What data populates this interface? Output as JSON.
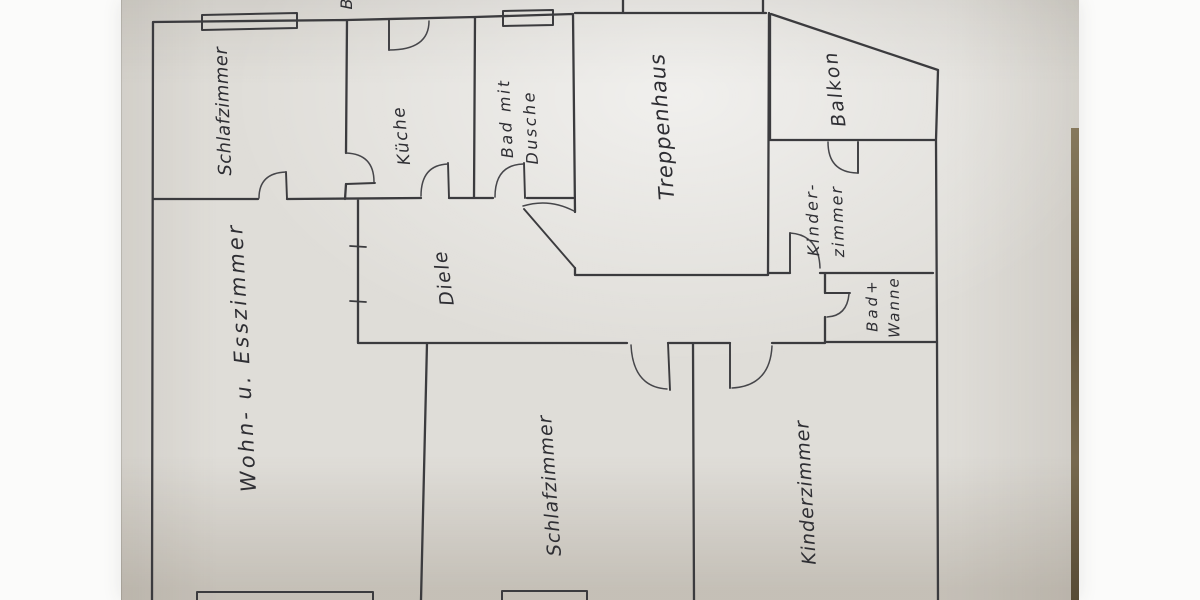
{
  "photo": {
    "description": "hand-drawn apartment floor plan on paper",
    "margin_color": "#fbfbfa",
    "paper_color": "#dfddd8",
    "ink_color": "#3b3b3e",
    "table_edge_color": "#5a4c31"
  },
  "floorplan": {
    "partial_top_label": "B",
    "rooms": [
      {
        "id": "schlafzimmer-oben",
        "label": "Schlafzimmer"
      },
      {
        "id": "kueche",
        "label": "Küche"
      },
      {
        "id": "bad-mit-dusche",
        "label": "Bad mit",
        "label2": "Dusche"
      },
      {
        "id": "treppenhaus",
        "label": "Treppenhaus"
      },
      {
        "id": "balkon",
        "label": "Balkon"
      },
      {
        "id": "kinderzimmer-oben",
        "label": "Kinder-",
        "label2": "zimmer"
      },
      {
        "id": "bad-wanne",
        "label": "Bad+",
        "label2": "Wanne"
      },
      {
        "id": "diele",
        "label": "Diele"
      },
      {
        "id": "wohn-esszimmer",
        "label": "Wohn- u. Esszimmer"
      },
      {
        "id": "schlafzimmer-unten",
        "label": "Schlafzimmer"
      },
      {
        "id": "kinderzimmer-unten",
        "label": "Kinderzimmer"
      }
    ]
  }
}
